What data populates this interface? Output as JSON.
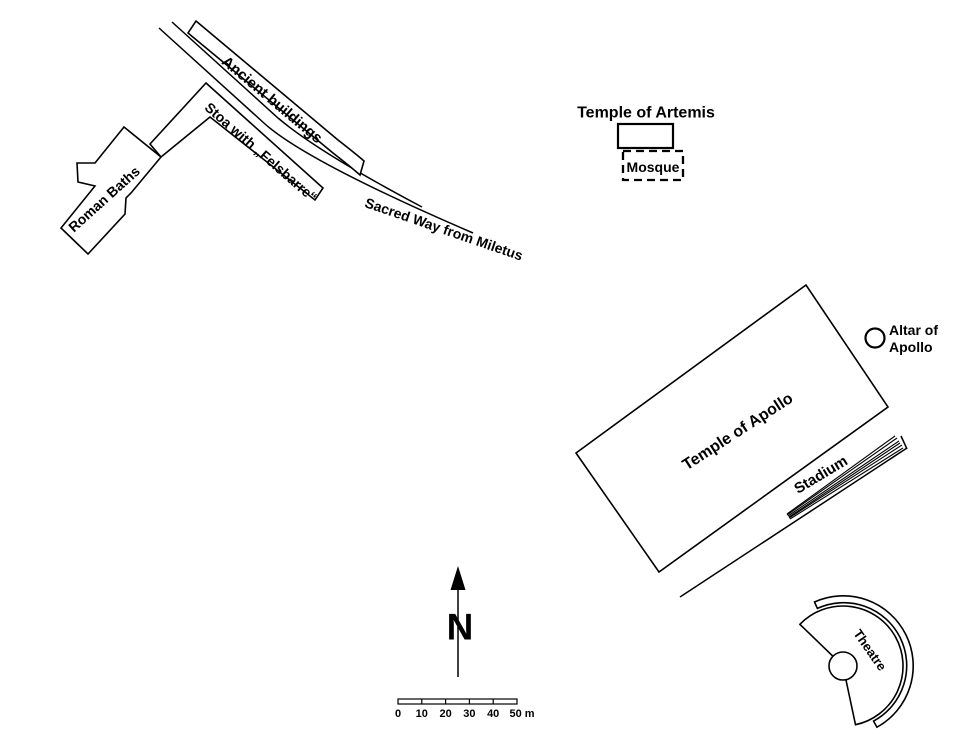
{
  "structures": {
    "ancient_buildings": {
      "label": "Ancient buildings"
    },
    "stoa": {
      "label": "Stoa with „Felsbarre“"
    },
    "roman_baths": {
      "label": "Roman Baths"
    },
    "sacred_way": {
      "label": "Sacred Way from Miletus"
    },
    "temple_of_artemis": {
      "label": "Temple of Artemis"
    },
    "mosque": {
      "label": "Mosque",
      "text_color": "#8f8f8f"
    },
    "temple_of_apollo": {
      "label": "Temple of Apollo"
    },
    "altar_of_apollo": {
      "label_line1": "Altar of",
      "label_line2": "Apollo"
    },
    "stadium": {
      "label": "Stadium"
    },
    "theatre": {
      "label": "Theatre"
    }
  },
  "compass": {
    "north_label": "N"
  },
  "scale_bar": {
    "tick_labels": [
      "0",
      "10",
      "20",
      "30",
      "40"
    ],
    "end_label": "50 m"
  },
  "colors": {
    "ink": "#000000",
    "background": "#ffffff",
    "mosque_text": "#8f8f8f"
  }
}
